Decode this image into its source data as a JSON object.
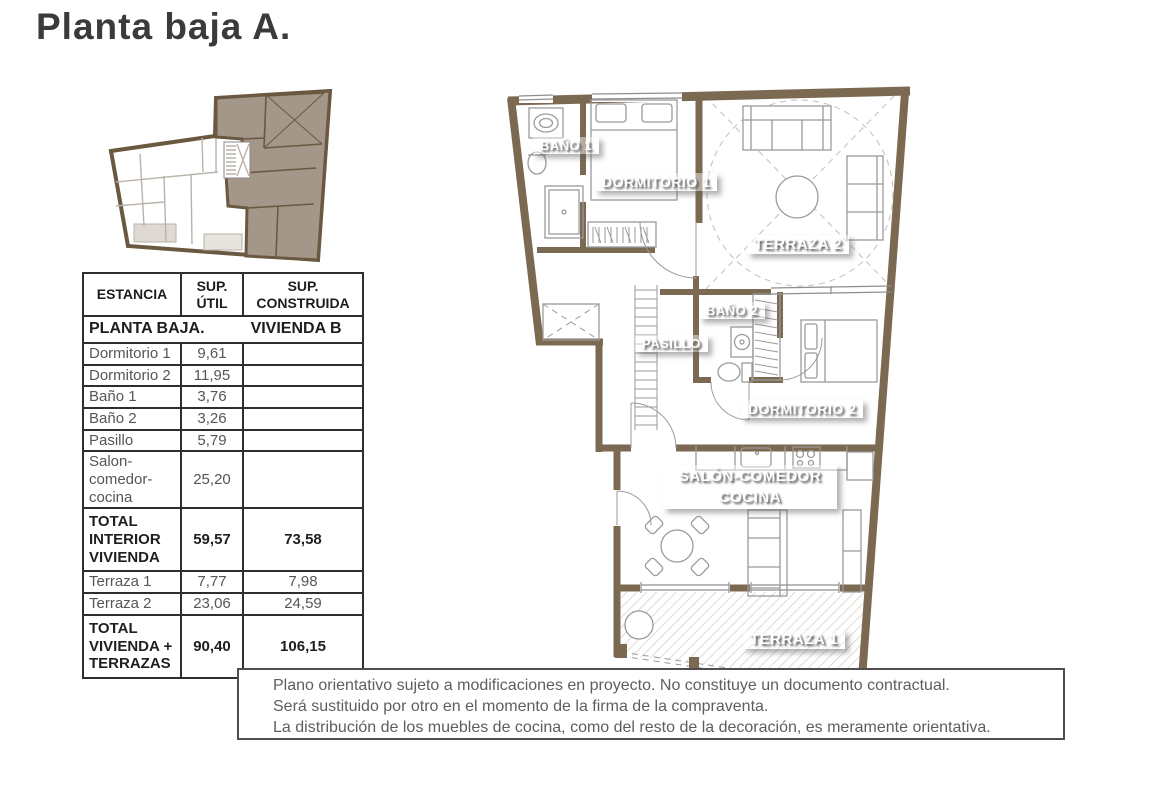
{
  "title": "Planta baja A.",
  "table": {
    "headers": [
      "ESTANCIA",
      "SUP. ÚTIL",
      "SUP. CONSTRUIDA"
    ],
    "section": {
      "left": "PLANTA BAJA.",
      "right": "VIVIENDA B"
    },
    "rows": [
      {
        "name": "Dormitorio 1",
        "util": "9,61",
        "construida": "",
        "bold": false
      },
      {
        "name": "Dormitorio 2",
        "util": "11,95",
        "construida": "",
        "bold": false
      },
      {
        "name": "Baño 1",
        "util": "3,76",
        "construida": "",
        "bold": false
      },
      {
        "name": "Baño 2",
        "util": "3,26",
        "construida": "",
        "bold": false
      },
      {
        "name": "Pasillo",
        "util": "5,79",
        "construida": "",
        "bold": false
      },
      {
        "name": "Salon-comedor-cocina",
        "util": "25,20",
        "construida": "",
        "bold": false
      },
      {
        "name": "TOTAL INTERIOR VIVIENDA",
        "util": "59,57",
        "construida": "73,58",
        "bold": true
      },
      {
        "name": "Terraza 1",
        "util": "7,77",
        "construida": "7,98",
        "bold": false
      },
      {
        "name": "Terraza 2",
        "util": "23,06",
        "construida": "24,59",
        "bold": false
      },
      {
        "name": "TOTAL VIVIENDA + TERRAZAS",
        "util": "90,40",
        "construida": "106,15",
        "bold": true
      }
    ]
  },
  "plan_labels": {
    "bano1": "BAÑO 1",
    "dormitorio1": "DORMITORIO 1",
    "terraza2": "TERRAZA 2",
    "bano2": "BAÑO 2",
    "pasillo": "PASILLO",
    "dormitorio2": "DORMITORIO 2",
    "salon_line1": "SALÓN-COMEDOR",
    "salon_line2": "COCINA",
    "terraza1": "TERRAZA 1"
  },
  "disclaimer": {
    "lines": [
      "Plano orientativo sujeto a modificaciones en proyecto. No constituye un documento contractual.",
      "Será sustituido por otro en el momento de la firma de la compraventa.",
      "La distribución de los muebles de cocina, como del resto de la decoración, es meramente orientativa."
    ]
  },
  "colors": {
    "wall": "#7b6951",
    "key_wall": "#6a5840",
    "key_unit_fill": "#a4978a"
  }
}
